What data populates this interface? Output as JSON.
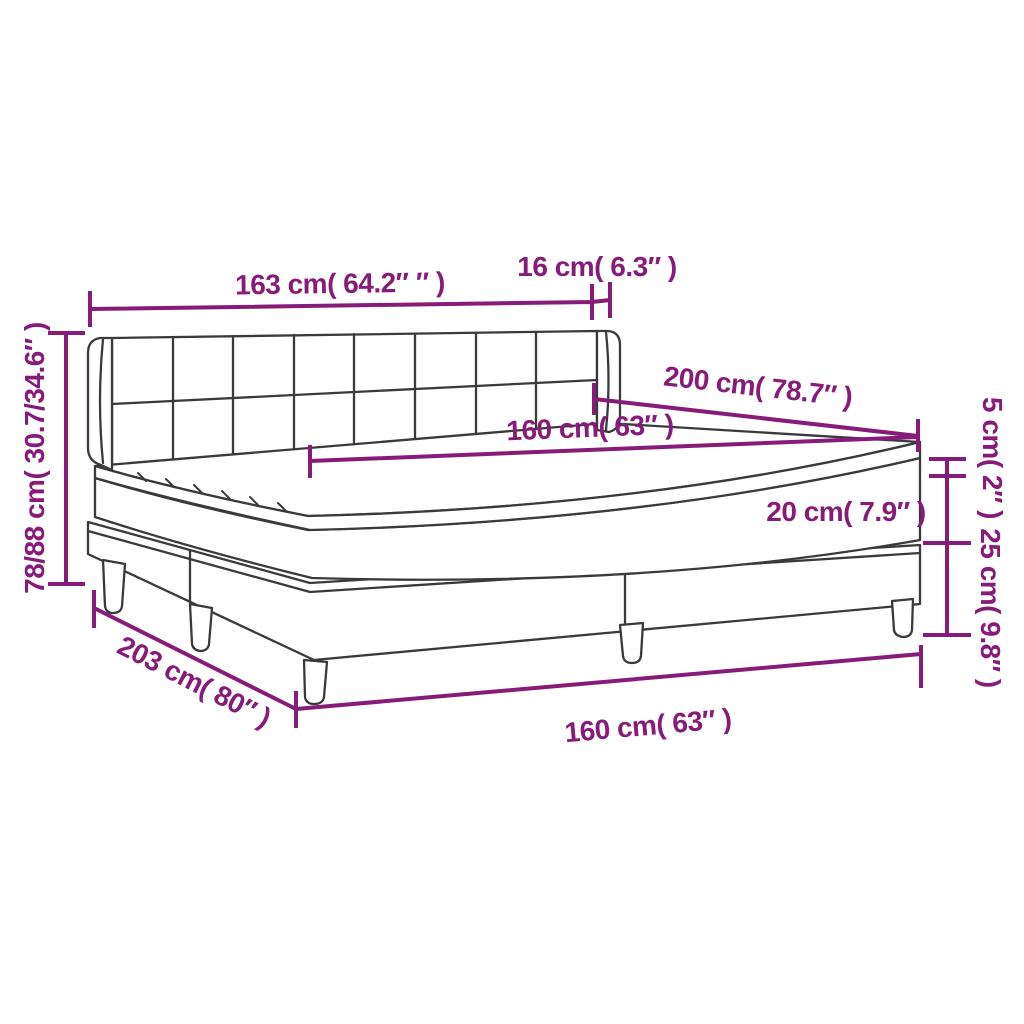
{
  "diagram": {
    "title": "box-spring-bed-dimension-diagram",
    "colors": {
      "dimension_accent": "#871B7A",
      "outline": "#3A3A3A",
      "background": "#FFFFFF"
    },
    "labels": {
      "headboard_width": "163 cm( 64.2″ ″ )",
      "headboard_side_depth": "16 cm( 6.3″ )",
      "bed_length_top": "200 cm( 78.7″ )",
      "mattress_width": "160 cm( 63″ )",
      "topper_thickness": "5 cm( 2″ )",
      "mattress_thickness": "20 cm( 7.9″ )",
      "base_height": "25 cm( 9.8″ )",
      "overall_height": "78/88 cm( 30.7/34.6″ )",
      "base_length": "203 cm( 80″ )",
      "base_width": "160 cm( 63″ )"
    }
  }
}
